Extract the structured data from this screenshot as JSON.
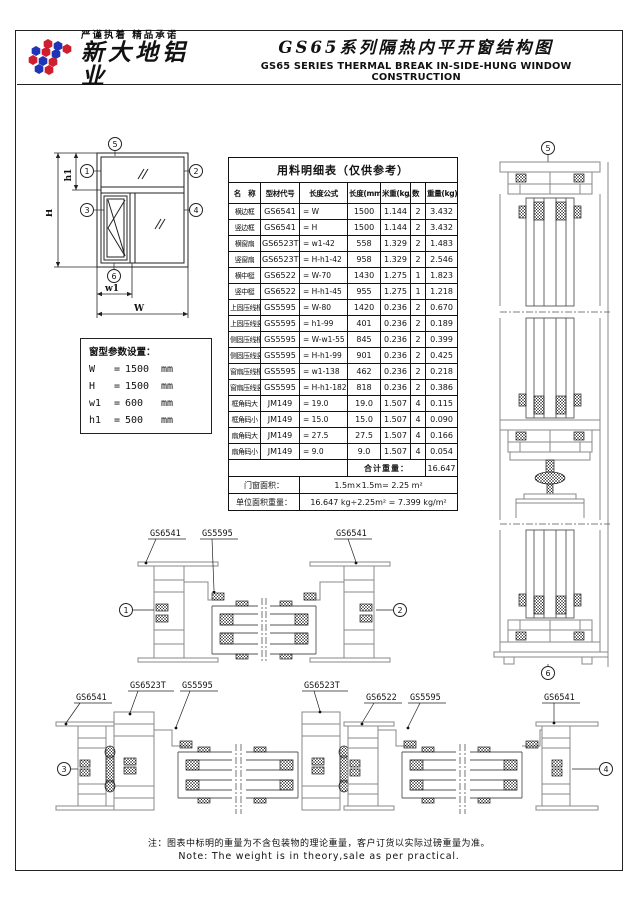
{
  "header": {
    "slogan": "严谨执着  精品承诺",
    "company": "新大地铝业",
    "title_cn": "GS65系列隔热内平开窗结构图",
    "title_en": "GS65 SERIES THERMAL BREAK IN-SIDE-HUNG WINDOW CONSTRUCTION"
  },
  "diagram": {
    "callouts": [
      "1",
      "2",
      "3",
      "4",
      "5",
      "6"
    ],
    "dims": {
      "H": "H",
      "h1": "h1",
      "W": "W",
      "w1": "w1"
    }
  },
  "params": {
    "title": "窗型参数设置：",
    "eq": "=",
    "items": [
      {
        "name": "W",
        "value": "1500",
        "unit": "mm"
      },
      {
        "name": "H",
        "value": "1500",
        "unit": "mm"
      },
      {
        "name": "w1",
        "value": "600",
        "unit": "mm"
      },
      {
        "name": "h1",
        "value": "500",
        "unit": "mm"
      }
    ]
  },
  "table": {
    "title": "用料明细表（仅供参考）",
    "headers": [
      "名　称",
      "型材代号",
      "长度公式",
      "长度(mm)",
      "米重(kg/m)",
      "数　量",
      "重量(kg)"
    ],
    "rows": [
      [
        "横边框",
        "GS6541",
        "= W",
        "1500",
        "1.144",
        "2",
        "3.432"
      ],
      [
        "竖边框",
        "GS6541",
        "= H",
        "1500",
        "1.144",
        "2",
        "3.432"
      ],
      [
        "横窗扇",
        "GS6523T",
        "= w1-42",
        "558",
        "1.329",
        "2",
        "1.483"
      ],
      [
        "竖窗扇",
        "GS6523T",
        "= H-h1-42",
        "958",
        "1.329",
        "2",
        "2.546"
      ],
      [
        "横中梃",
        "GS6522",
        "= W-70",
        "1430",
        "1.275",
        "1",
        "1.823"
      ],
      [
        "竖中梃",
        "GS6522",
        "= H-h1-45",
        "955",
        "1.275",
        "1",
        "1.218"
      ],
      [
        "上固压线横",
        "GS5595",
        "= W-80",
        "1420",
        "0.236",
        "2",
        "0.670"
      ],
      [
        "上固压线竖",
        "GS5595",
        "= h1-99",
        "401",
        "0.236",
        "2",
        "0.189"
      ],
      [
        "侧固压线横",
        "GS5595",
        "= W-w1-55",
        "845",
        "0.236",
        "2",
        "0.399"
      ],
      [
        "侧固压线竖",
        "GS5595",
        "= H-h1-99",
        "901",
        "0.236",
        "2",
        "0.425"
      ],
      [
        "窗扇压线横",
        "GS5595",
        "= w1-138",
        "462",
        "0.236",
        "2",
        "0.218"
      ],
      [
        "窗扇压线竖",
        "GS5595",
        "= H-h1-182",
        "818",
        "0.236",
        "2",
        "0.386"
      ],
      [
        "框角码大",
        "JM149",
        "= 19.0",
        "19.0",
        "1.507",
        "4",
        "0.115"
      ],
      [
        "框角码小",
        "JM149",
        "= 15.0",
        "15.0",
        "1.507",
        "4",
        "0.090"
      ],
      [
        "扇角码大",
        "JM149",
        "= 27.5",
        "27.5",
        "1.507",
        "4",
        "0.166"
      ],
      [
        "扇角码小",
        "JM149",
        "= 9.0",
        "9.0",
        "1.507",
        "4",
        "0.054"
      ]
    ],
    "total_label": "合计重量：",
    "total_value": "16.647",
    "area_label": "门窗面积：",
    "area_value": "1.5m×1.5m= 2.25 m²",
    "unit_weight_label": "单位面积重量：",
    "unit_weight_value": "16.647 kg÷2.25m² = 7.399 kg/m²"
  },
  "sections": {
    "mid_left": [
      "GS6541",
      "GS5595"
    ],
    "mid_right": [
      "GS6541"
    ],
    "bottom_left": [
      "GS6541",
      "GS6523T",
      "GS5595"
    ],
    "bottom_right": [
      "GS6523T",
      "GS6522",
      "GS5595",
      "GS6541"
    ]
  },
  "footer": {
    "note_cn": "注：图表中标明的重量为不含包装物的理论重量，客户订货以实际过磅重量为准。",
    "note_en": "Note: The weight is in theory,sale as per practical."
  }
}
